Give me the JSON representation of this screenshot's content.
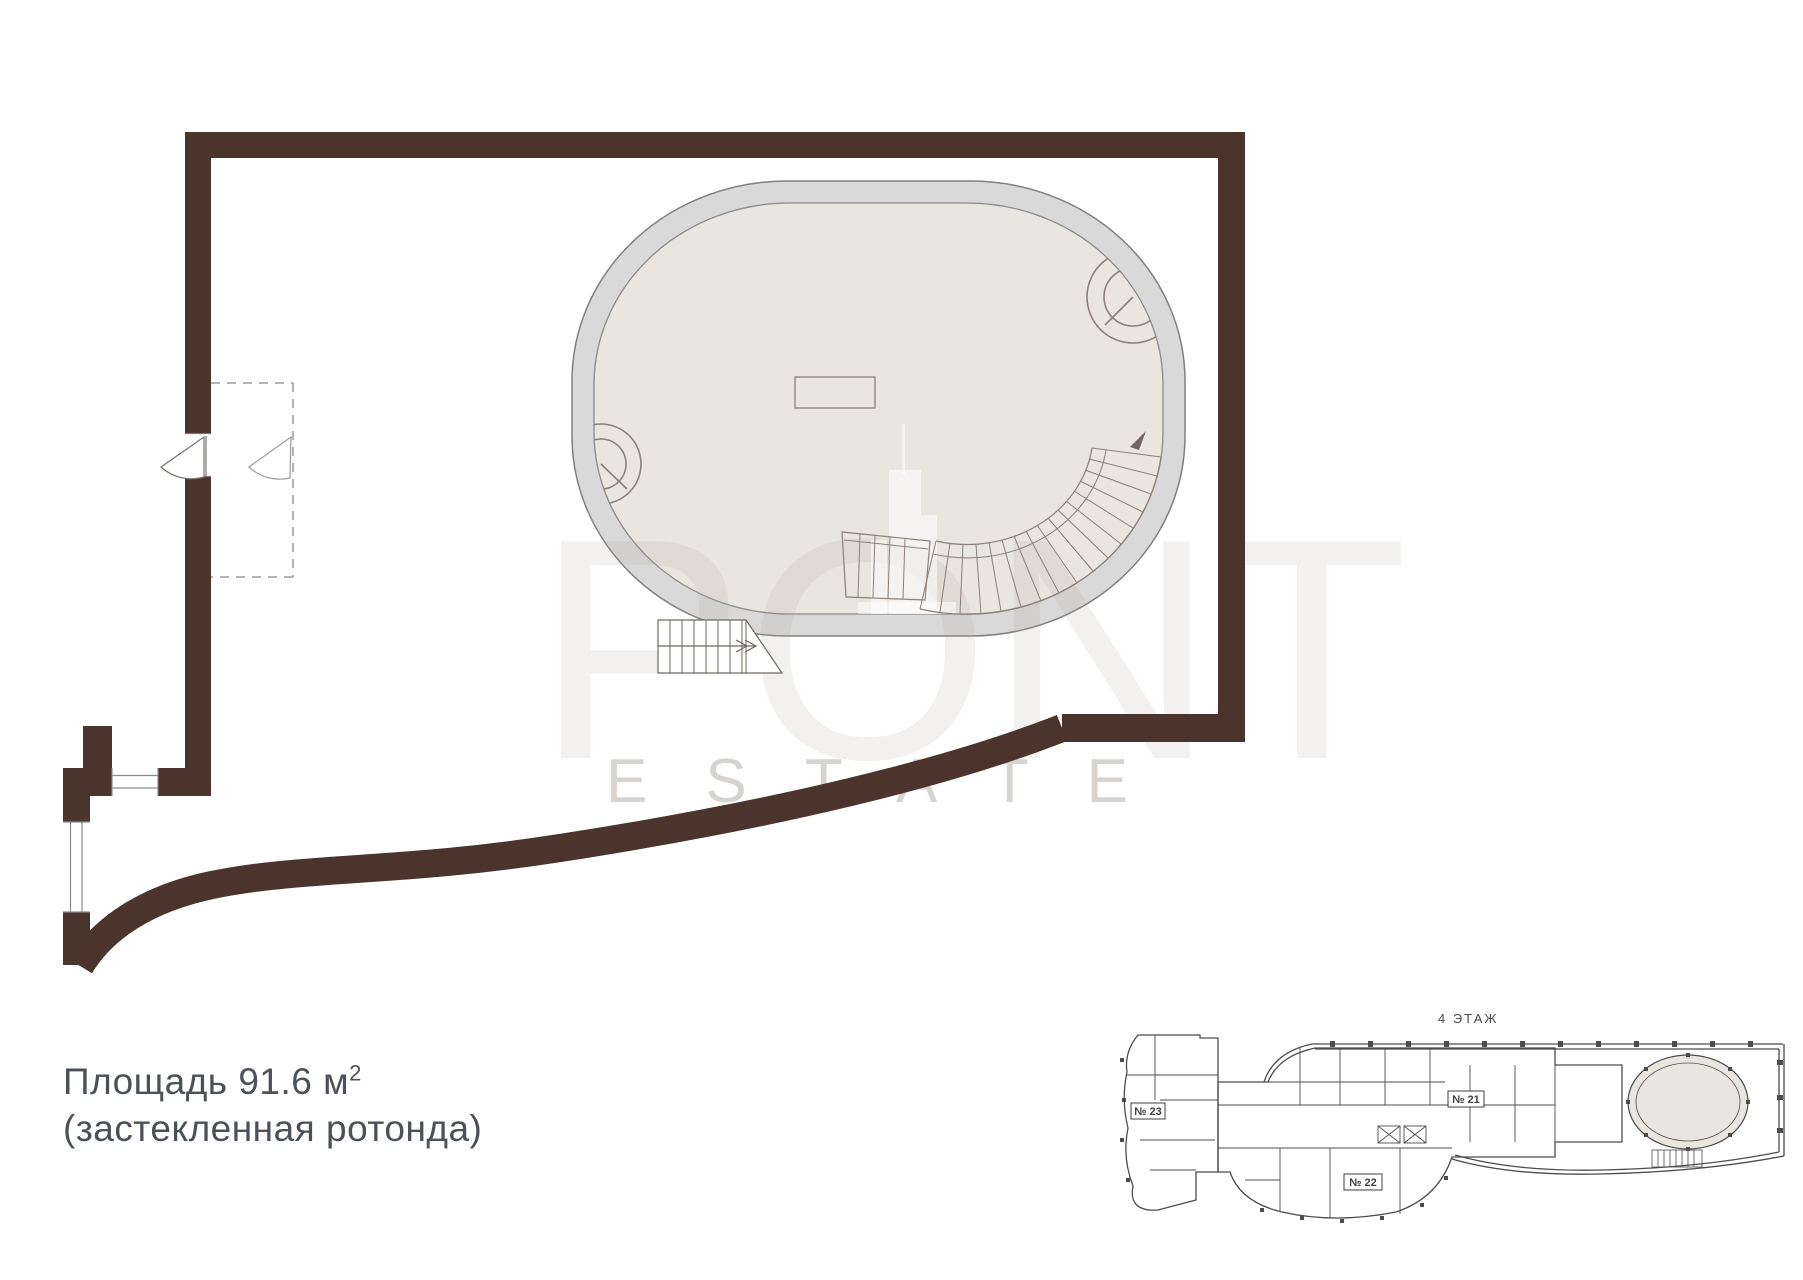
{
  "title_block": {
    "area_text": "Площадь 91.6 м",
    "area_sup": "2",
    "subtitle": "(застекленная ротонда)"
  },
  "mini_plan": {
    "floor_label": "4 ЭТАЖ",
    "unit_21": "№ 21",
    "unit_22": "№ 22",
    "unit_23": "№ 23"
  },
  "watermark": {
    "left_letters": "PO",
    "right_letters": "NT",
    "bottom_word": "ESTATE"
  },
  "colors": {
    "wall_brown": "#4a342b",
    "ring_gray": "#d9d9d9",
    "inner_beige": "#e9e5df",
    "line_warm": "#8b8177",
    "stair_line": "#6f675f",
    "mini_line": "#4c4c4c",
    "text_dark": "#4c5157"
  }
}
